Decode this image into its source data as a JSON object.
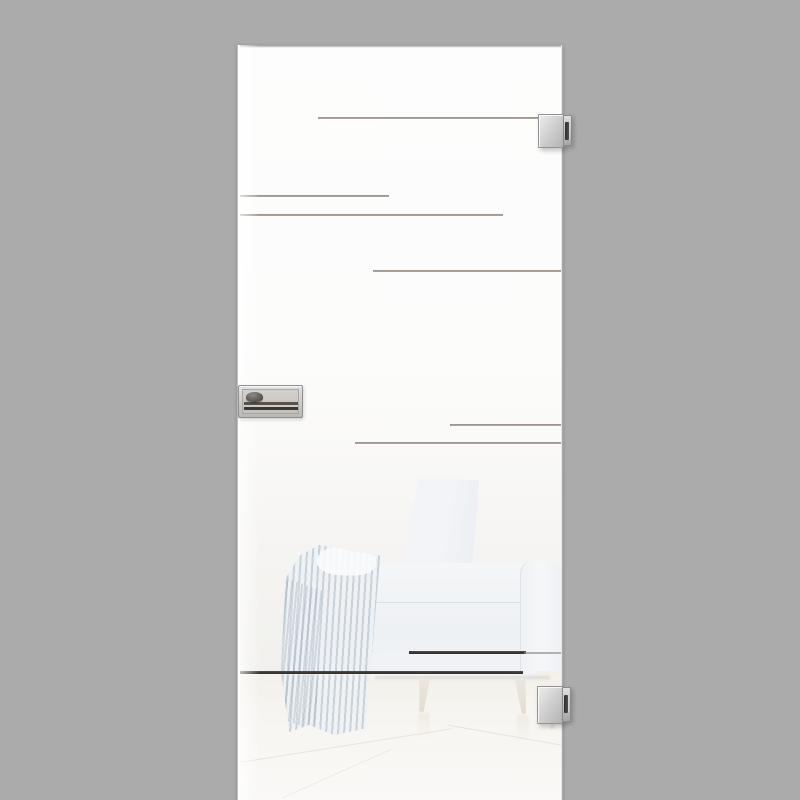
{
  "meta": {
    "description": "Product photograph of a frameless white satin-glass interior door with etched horizontal line decor, two square stainless-steel glass-door hinges on the right edge, a flush stainless lock plate on the left edge, and a faint showroom reflection of a white armchair with a striped throw blanket on a pale floor."
  },
  "palette": {
    "background": "#ababab",
    "glass_white": "#fbfbfa",
    "etch_line_light": "#a29a93",
    "etch_line_dark": "#3d3934",
    "hardware_light": "#e6e6e6",
    "hardware_mid": "#bdbdbd",
    "hardware_border": "#8f8f8f",
    "slot_dark": "#3a3a3a",
    "reflection_chair": "#f1f3f6",
    "reflection_blanket": "#dbe2e8",
    "reflection_floor": "#f6f3ee",
    "leg_wood": "#e9e3d9"
  },
  "door": {
    "x": 237,
    "y": 45,
    "width": 326,
    "height": 755,
    "etched_lines": [
      {
        "x": 318,
        "y": 117,
        "length": 222,
        "thickness": 2,
        "tone": "light"
      },
      {
        "x": 238,
        "y": 195,
        "length": 151,
        "thickness": 2,
        "tone": "light"
      },
      {
        "x": 238,
        "y": 214,
        "length": 265,
        "thickness": 2,
        "tone": "light"
      },
      {
        "x": 373,
        "y": 270,
        "length": 190,
        "thickness": 2,
        "tone": "light"
      },
      {
        "x": 450,
        "y": 424,
        "length": 113,
        "thickness": 2,
        "tone": "light"
      },
      {
        "x": 355,
        "y": 442,
        "length": 208,
        "thickness": 2,
        "tone": "light"
      },
      {
        "x": 409,
        "y": 651,
        "length": 117,
        "thickness": 3,
        "tone": "dark"
      },
      {
        "x": 524,
        "y": 652,
        "length": 38,
        "thickness": 2,
        "tone": "mid"
      },
      {
        "x": 238,
        "y": 671,
        "length": 285,
        "thickness": 3,
        "tone": "dark"
      }
    ]
  },
  "hardware": {
    "top_hinge": {
      "x": 538,
      "y": 114,
      "width": 35,
      "height": 34
    },
    "bottom_hinge": {
      "x": 537,
      "y": 686,
      "width": 35,
      "height": 38
    },
    "lock_plate": {
      "x": 238,
      "y": 385,
      "width": 65,
      "height": 33
    }
  }
}
